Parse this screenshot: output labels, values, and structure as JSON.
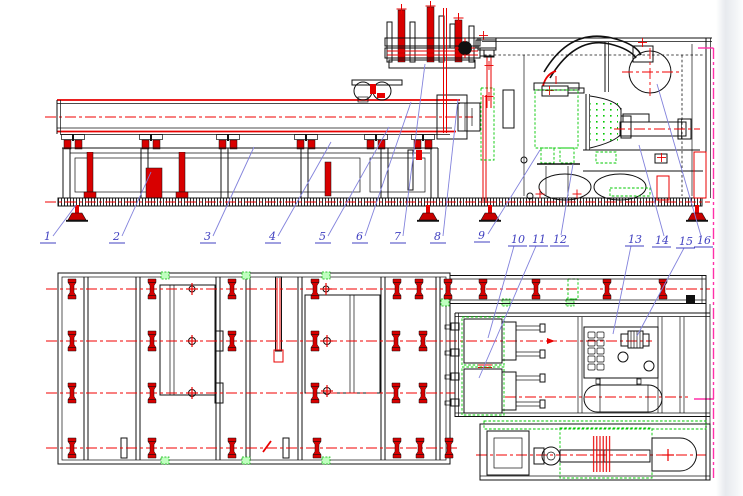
{
  "drawing": {
    "type": "engineering-assembly-drawing",
    "views": [
      "side-elevation",
      "plan-view"
    ],
    "part_labels": [
      {
        "id": "1"
      },
      {
        "id": "2"
      },
      {
        "id": "3"
      },
      {
        "id": "4"
      },
      {
        "id": "5"
      },
      {
        "id": "6"
      },
      {
        "id": "7"
      },
      {
        "id": "8"
      },
      {
        "id": "9"
      },
      {
        "id": "10"
      },
      {
        "id": "11"
      },
      {
        "id": "12"
      },
      {
        "id": "13"
      },
      {
        "id": "14"
      },
      {
        "id": "15"
      },
      {
        "id": "16"
      }
    ],
    "colors": {
      "background": "#ffffff",
      "line_black": "#101010",
      "accent_red": "#e80000",
      "accent_green": "#00c800",
      "boundary_magenta": "#ff30a8",
      "leader_blue": "#8282dc",
      "label_blue": "#4040c0"
    }
  }
}
